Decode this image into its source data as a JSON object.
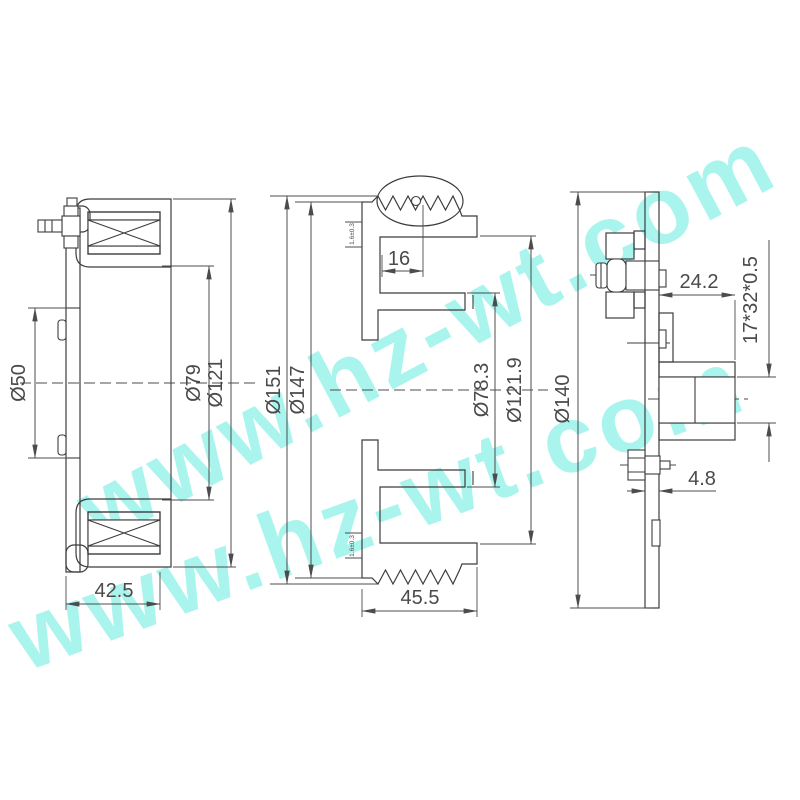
{
  "watermark": {
    "text": "www.hz-wt.com",
    "color": "#55EDDE"
  },
  "views": {
    "left": {
      "dims": {
        "d50": "Ø50",
        "d79": "Ø79",
        "d121": "Ø121",
        "width": "42.5"
      }
    },
    "middle": {
      "dims": {
        "d151": "Ø151",
        "d147": "Ø147",
        "offset": "16",
        "d78_3": "Ø78.3",
        "d121_9": "Ø121.9",
        "width": "45.5",
        "note": "1.6±0.3"
      }
    },
    "right": {
      "dims": {
        "d140": "Ø140",
        "depth": "24.2",
        "spline": "17*32*0.5",
        "thickness": "4.8"
      }
    }
  }
}
